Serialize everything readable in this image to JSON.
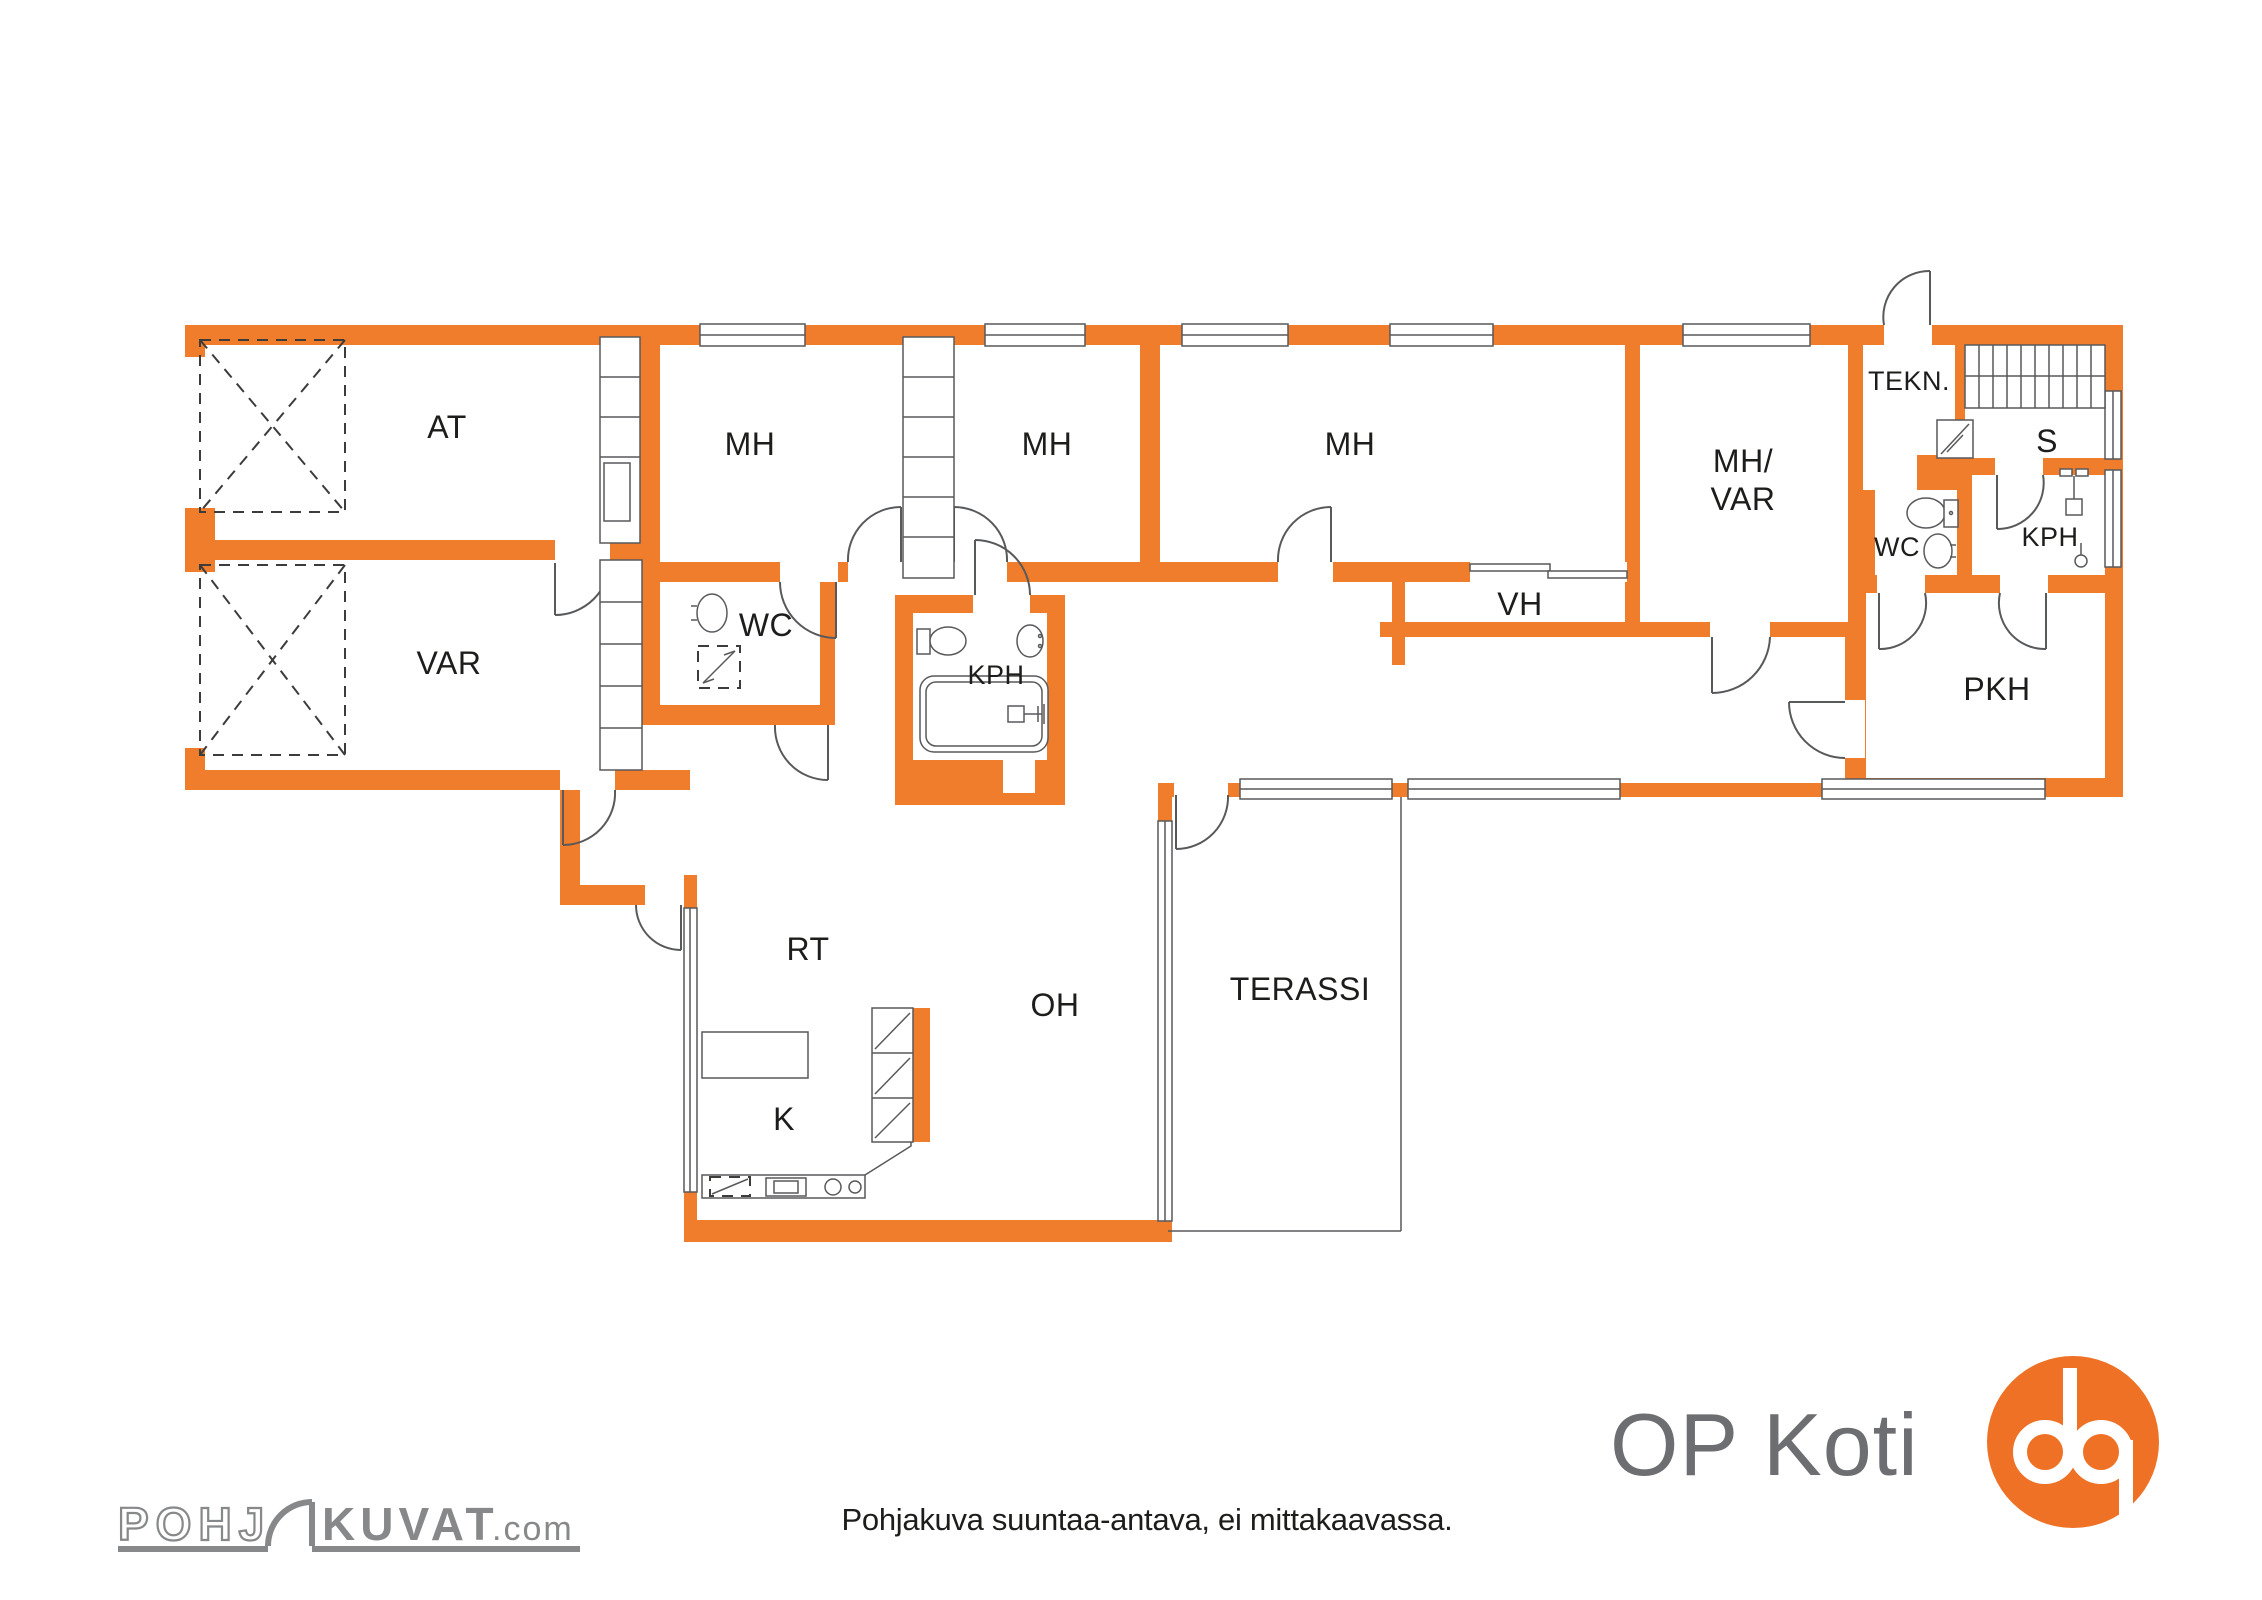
{
  "rooms": {
    "at": "AT",
    "mh1": "MH",
    "mh2": "MH",
    "mh3": "MH",
    "mh_var_1": "MH/",
    "mh_var_2": "VAR",
    "tekn": "TEKN.",
    "sauna": "S",
    "wc_right": "WC",
    "kph_right": "KPH",
    "vh": "VH",
    "var": "VAR",
    "wc_mid": "WC",
    "kph_mid": "KPH",
    "pkh": "PKH",
    "rt": "RT",
    "oh": "OH",
    "terassi": "TERASSI",
    "k": "K"
  },
  "footer": {
    "disclaimer": "Pohjakuva suuntaa-antava, ei mittakaavassa."
  },
  "branding": {
    "op_koti": "OP Koti",
    "watermark_pohj": "POHJ",
    "watermark_kuvat": "KUVAT",
    "watermark_com": ".com"
  },
  "colors": {
    "wall": "#EF7D2C",
    "line": "#58595B",
    "text": "#1D1D1B",
    "logo_orange": "#EE7125",
    "logo_gray": "#6D6E71",
    "wm_gray": "#87888A"
  }
}
